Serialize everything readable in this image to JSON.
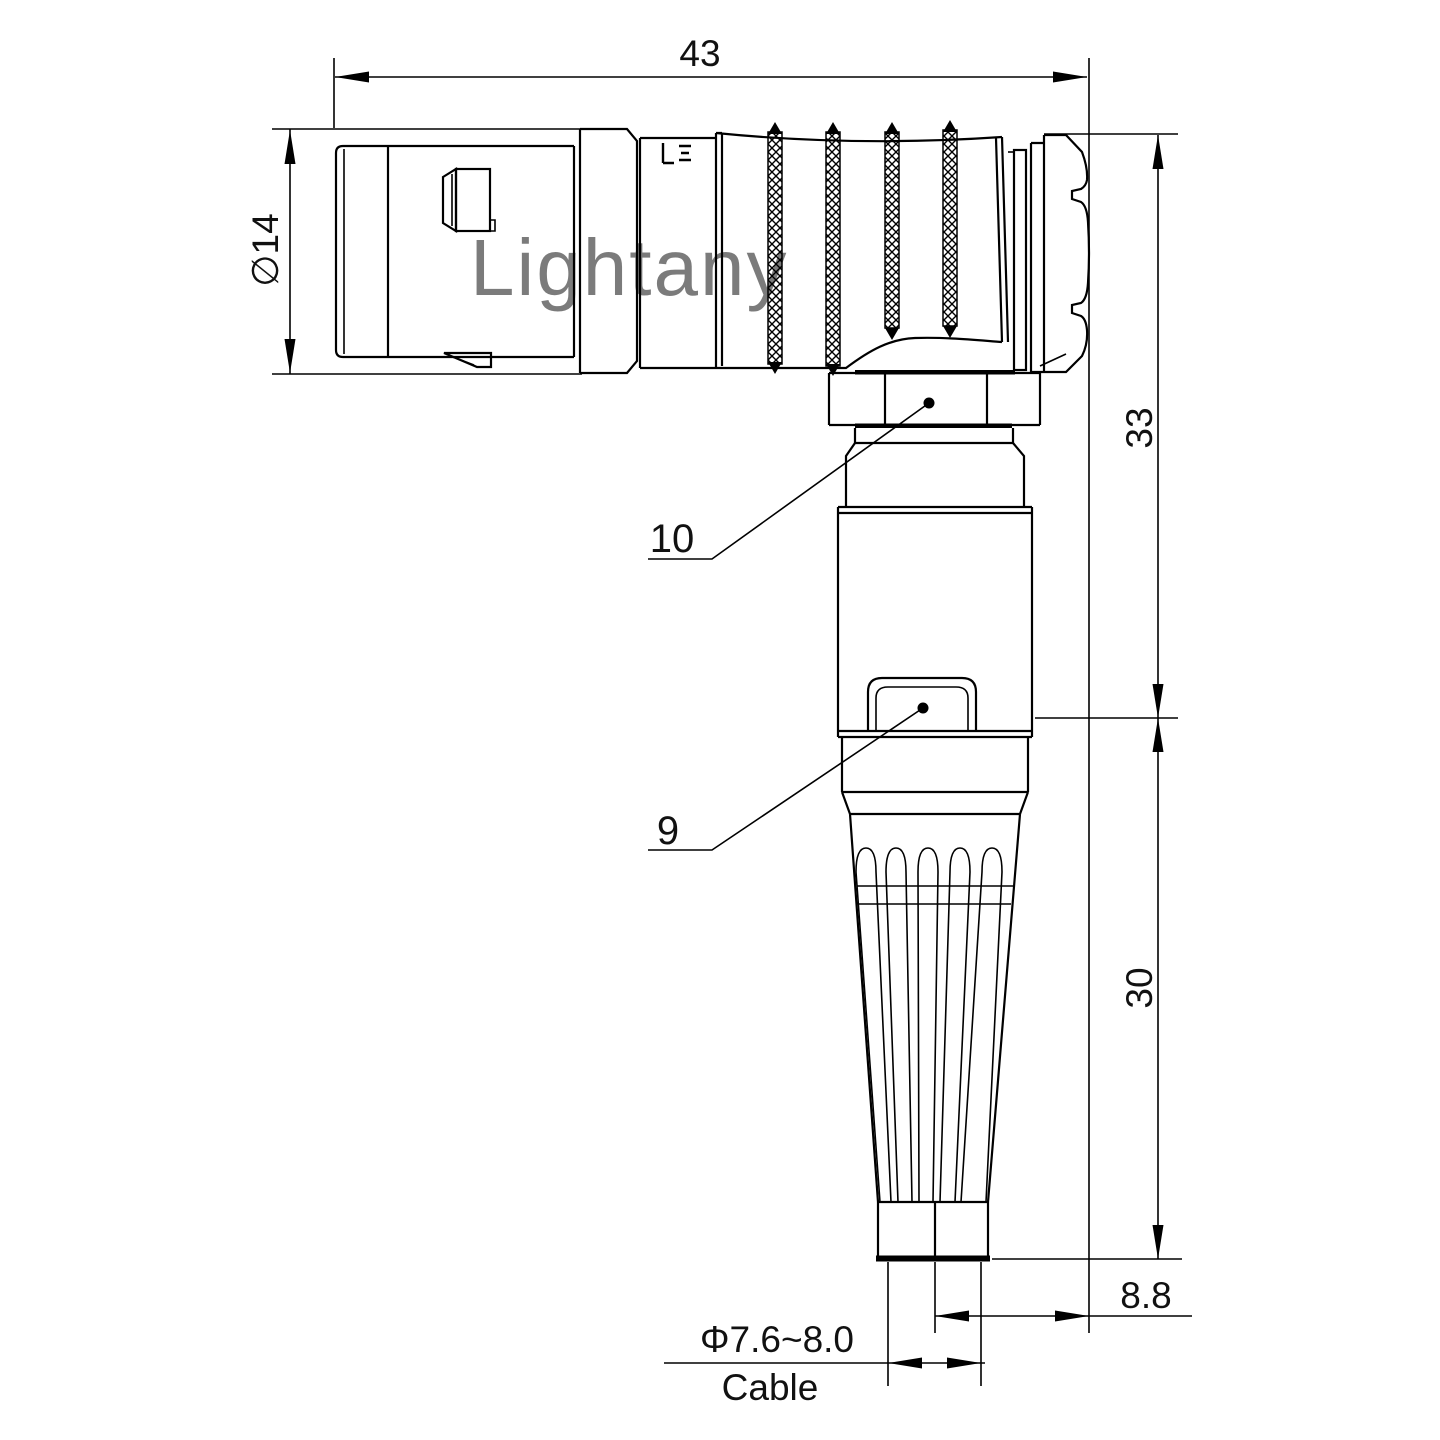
{
  "watermark": {
    "text": "Lightany"
  },
  "dimensions": {
    "overall_length": "43",
    "shell_diameter": "∅14",
    "upper_section_height": "33",
    "boot_section_height": "30",
    "cable_axis_offset": "8.8",
    "cable_diameter_range": "Φ7.6~8.0",
    "cable_label": "Cable"
  },
  "part_labels": {
    "coupling_nut": "10",
    "release_latch": "9"
  },
  "colors": {
    "line": "#000000",
    "background": "#ffffff",
    "watermark": "#f0b9ba"
  }
}
